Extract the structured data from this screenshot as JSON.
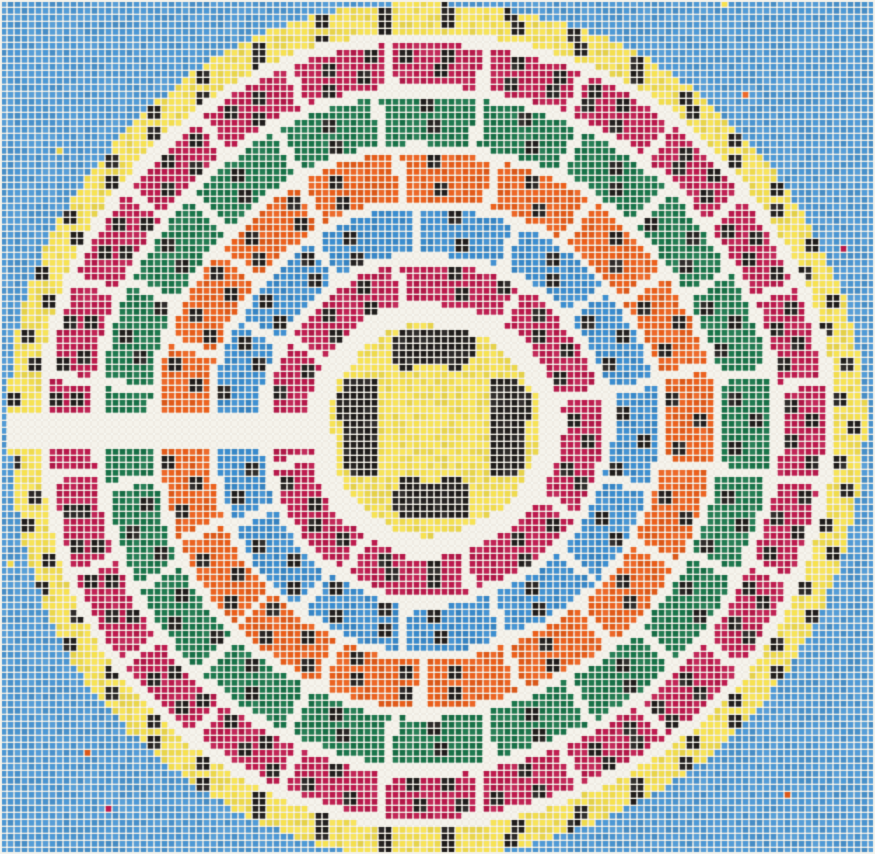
{
  "artwork": {
    "description": "needlepoint cross-stitch pattern of a circular stadium / arena seating plan",
    "width": 875,
    "height": 854
  },
  "palette": {
    "canvas_white": "#F5F3EC",
    "weave_line": "#E6E2D7",
    "mesh_hole": "#FDFCF8",
    "background_blue": "#4C98D5",
    "ring_blue": "#3A8DD0",
    "red": "#BE1A4E",
    "green": "#19764B",
    "orange": "#EC5F1B",
    "yellow": "#F7E24F",
    "black": "#211E1D"
  },
  "stitch": {
    "pitch": 7,
    "size": 5.4,
    "highlight": 0.5,
    "black_highlight": 0.28,
    "jitter": 0.16,
    "stray_probability": 0.0015
  },
  "geometry": {
    "center": {
      "x": 434,
      "y": 429
    },
    "field_disc": {
      "radius": 105,
      "moat_outer": 126,
      "color": "yellow"
    },
    "entry_channel": {
      "angle_deg": 180,
      "half_width_px": 16
    },
    "divider_gap_px": 9,
    "wobble": {
      "a1": 2.2,
      "f1": 3,
      "p1": 1.3,
      "a2": 1.5,
      "f2": 7,
      "p2": 0.7
    },
    "rings": [
      {
        "name": "outer-promenade",
        "color": "yellow",
        "outer": 428,
        "inner": 398,
        "divider_count": 0,
        "divider_offset_deg": 0,
        "cluster_rows": [
          420,
          406
        ],
        "cluster_step_px": 65
      },
      {
        "name": "tier-1",
        "color": "red",
        "outer": 387,
        "inner": 345,
        "divider_count": 24,
        "divider_offset_deg": 7,
        "cluster_rows": [
          376,
          356
        ],
        "cluster_step_px": 38
      },
      {
        "name": "tier-2",
        "color": "green",
        "outer": 335,
        "inner": 287,
        "divider_count": 20,
        "divider_offset_deg": 10,
        "cluster_rows": [
          322,
          300
        ],
        "cluster_step_px": 50
      },
      {
        "name": "tier-3",
        "color": "orange",
        "outer": 278,
        "inner": 230,
        "divider_count": 17,
        "divider_offset_deg": 13,
        "cluster_rows": [
          265,
          243
        ],
        "cluster_step_px": 50
      },
      {
        "name": "tier-4",
        "color": "ring_blue",
        "outer": 222,
        "inner": 177,
        "divider_count": 13,
        "divider_offset_deg": 12,
        "cluster_rows": [
          210,
          189
        ],
        "cluster_step_px": 52
      },
      {
        "name": "tier-5",
        "color": "red",
        "outer": 167,
        "inner": 127,
        "divider_count": 8,
        "divider_offset_deg": 13,
        "cluster_rows": [
          155,
          139
        ],
        "cluster_step_px": 46
      }
    ],
    "field_structures": [
      {
        "x": 393,
        "y": 331,
        "w": 80,
        "h": 33,
        "r": 9
      },
      {
        "x": 402,
        "y": 362,
        "w": 13,
        "h": 11,
        "r": 3
      },
      {
        "x": 447,
        "y": 360,
        "w": 16,
        "h": 11,
        "r": 3
      },
      {
        "x": 395,
        "y": 485,
        "w": 77,
        "h": 33,
        "r": 11
      },
      {
        "x": 400,
        "y": 478,
        "w": 18,
        "h": 12,
        "r": 4
      },
      {
        "x": 441,
        "y": 478,
        "w": 22,
        "h": 12,
        "r": 4
      },
      {
        "x": 345,
        "y": 377,
        "w": 33,
        "h": 98,
        "r": 9
      },
      {
        "x": 337,
        "y": 391,
        "w": 13,
        "h": 28,
        "r": 4
      },
      {
        "x": 489,
        "y": 378,
        "w": 33,
        "h": 98,
        "r": 9
      },
      {
        "x": 521,
        "y": 391,
        "w": 13,
        "h": 28,
        "r": 4
      }
    ],
    "black_cluster_size_stitches": 2
  }
}
